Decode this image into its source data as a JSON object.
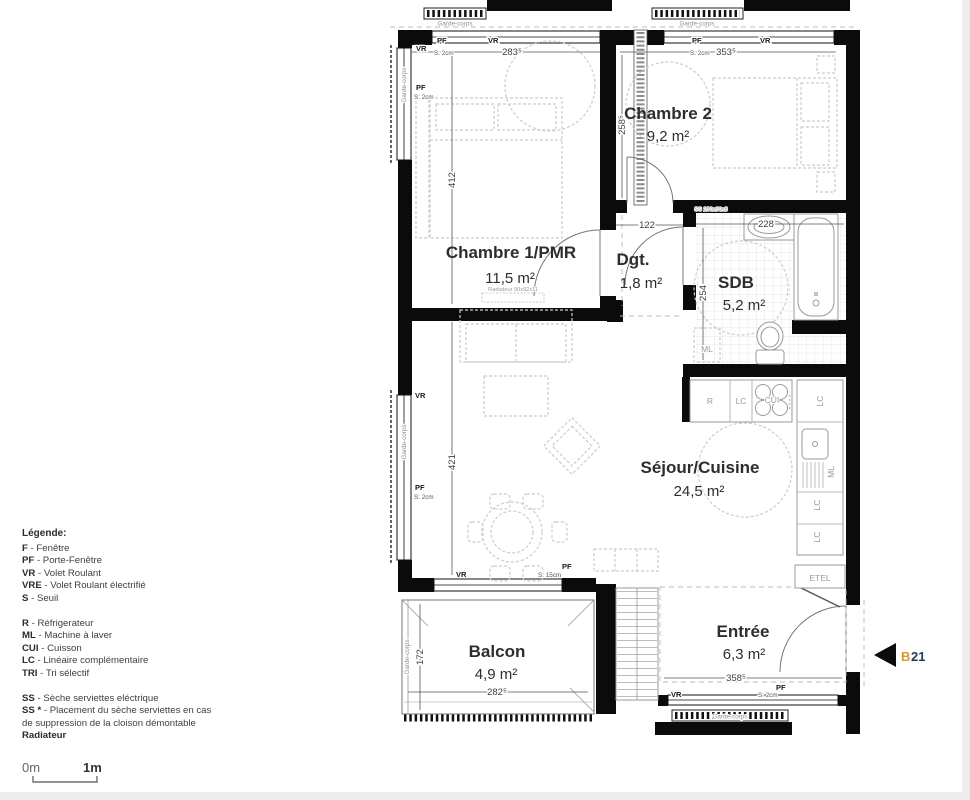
{
  "unit": {
    "prefix": "B",
    "number": "21"
  },
  "rooms": {
    "chambre2": {
      "name": "Chambre 2",
      "area": "9,2 m²"
    },
    "chambre1": {
      "name": "Chambre 1/PMR",
      "area": "11,5 m²"
    },
    "dgt": {
      "name": "Dgt.",
      "area": "1,8 m²"
    },
    "sdb": {
      "name": "SDB",
      "area": "5,2 m²"
    },
    "sejour": {
      "name": "Séjour/Cuisine",
      "area": "24,5 m²"
    },
    "balcon": {
      "name": "Balcon",
      "area": "4,9 m²"
    },
    "entree": {
      "name": "Entrée",
      "area": "6,3 m²"
    }
  },
  "dims": {
    "ch1_top": "283⁵",
    "ch2_top": "353⁵",
    "ch1_height": "412",
    "sejour_height": "421",
    "ch2_height": "258⁵",
    "dgt_width": "122",
    "sdb_width": "228",
    "sdb_height": "254",
    "balcon_height": "172",
    "balcon_width": "282⁵",
    "entree_width": "358⁵"
  },
  "labels": {
    "pf": "PF",
    "vr": "VR",
    "s2": "S: 2cm",
    "s15": "S: 15cm",
    "garde_corps": "Garde-corps",
    "radiateur_dim": "Radiateur 90x92x11",
    "ss_dim": "SS 130x60x8",
    "ml": "ML",
    "etel": "ETEL",
    "r": "R",
    "lc": "LC",
    "cui": "CUI"
  },
  "legend": {
    "title": "Légende:",
    "items": [
      {
        "abbr": "F",
        "text": "- Fenêtre"
      },
      {
        "abbr": "PF",
        "text": "- Porte-Fenêtre"
      },
      {
        "abbr": "VR",
        "text": "- Volet Roulant"
      },
      {
        "abbr": "VRE",
        "text": "- Volet Roulant électrifié"
      },
      {
        "abbr": "S",
        "text": "- Seuil"
      },
      {
        "abbr": "R",
        "text": "- Réfrigerateur"
      },
      {
        "abbr": "ML",
        "text": "- Machine à laver"
      },
      {
        "abbr": "CUI",
        "text": "- Cuisson"
      },
      {
        "abbr": "LC",
        "text": "- Linéaire complémentaire"
      },
      {
        "abbr": "TRI",
        "text": "- Tri sélectif"
      },
      {
        "abbr": "SS",
        "text": "- Sèche serviettes eléctrique"
      },
      {
        "abbr": "SS *",
        "text": "- Placement du sèche serviettes en cas de suppression de la cloison démontable"
      },
      {
        "abbr": "Radiateur",
        "text": ""
      }
    ]
  },
  "scale": {
    "zero": "0m",
    "one": "1m"
  }
}
